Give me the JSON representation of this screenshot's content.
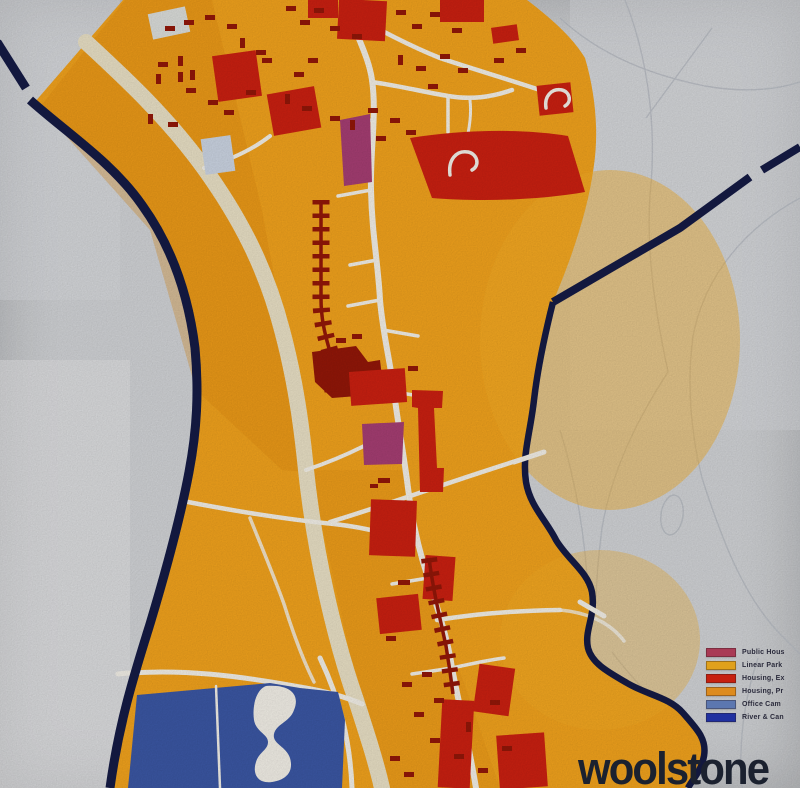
{
  "title": {
    "text": "woolstone"
  },
  "legend": {
    "items": [
      {
        "key": "public-housing",
        "label": "Public Hous",
        "color": "#a93a55"
      },
      {
        "key": "linear-park",
        "label": "Linear Park",
        "color": "#e0a11c"
      },
      {
        "key": "housing-existing",
        "label": "Housing, Ex",
        "color": "#c6200f"
      },
      {
        "key": "housing-proposed",
        "label": "Housing, Pr",
        "color": "#dd8b1e"
      },
      {
        "key": "office-campus",
        "label": "Office Cam",
        "color": "#5c77b0"
      },
      {
        "key": "river-canal",
        "label": "River & Can",
        "color": "#2030a0"
      }
    ]
  },
  "palette": {
    "background": "#d2d4d7",
    "land": "#f2a31d",
    "land_shade": "#e08a10",
    "land_bright": "#f7b027",
    "road_major": "#eae1c6",
    "road_minor": "#f3f0e8",
    "housing_existing": "#cb2011",
    "housing_dark": "#931708",
    "public_housing": "#a63e73",
    "water_lake": "#3b57a4",
    "waterway": "#151b45",
    "pale_blue_block": "#ccd5e3",
    "pale_block": "#dcdedb",
    "sketch_line": "#b9bdc4",
    "legend_text": "#2b2b3c",
    "title_color": "#1b212f"
  }
}
